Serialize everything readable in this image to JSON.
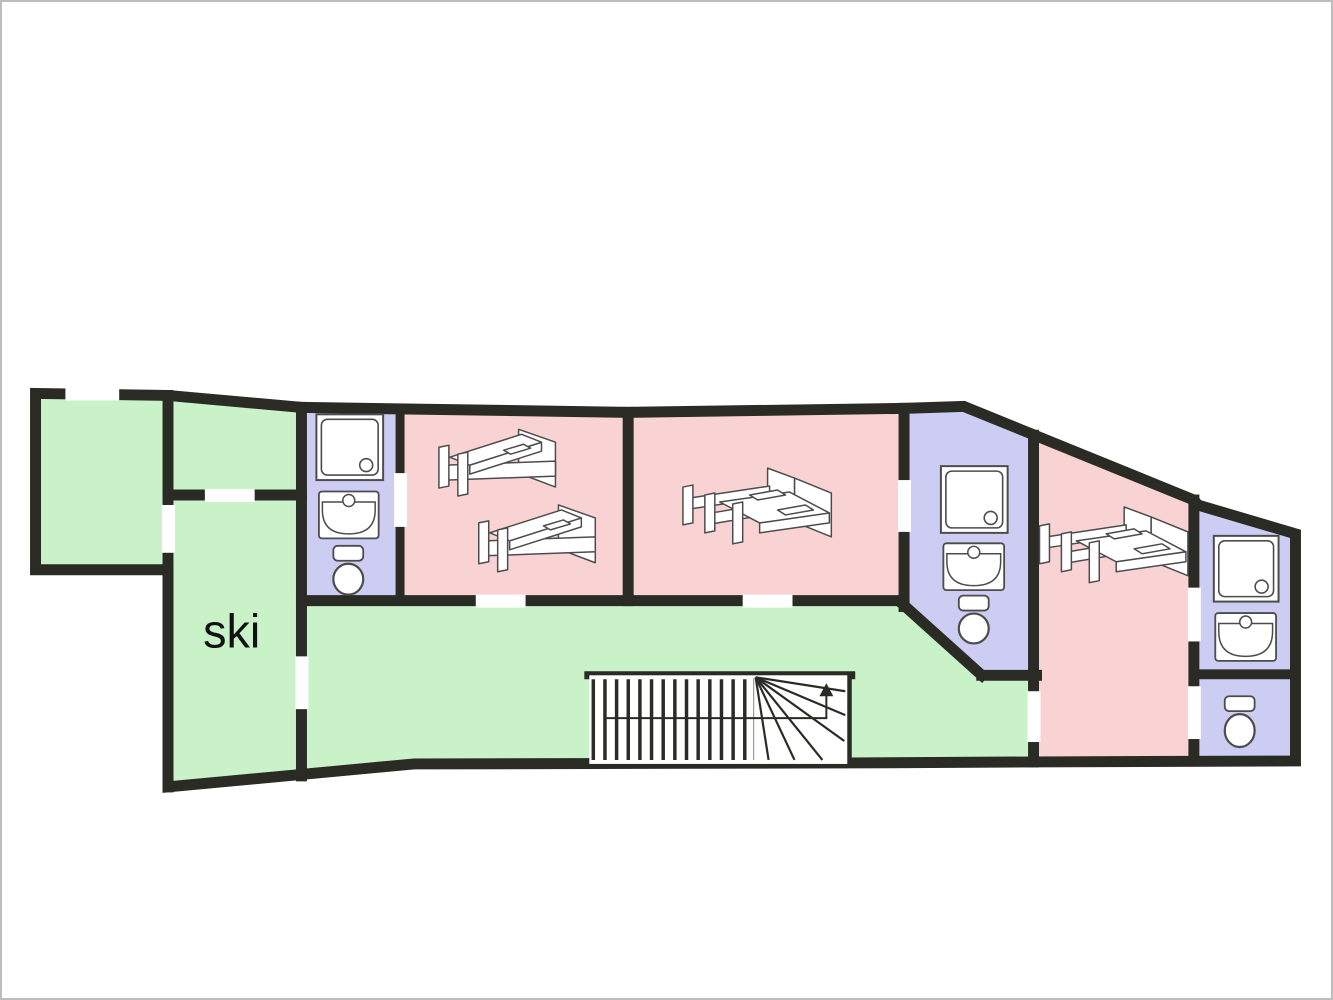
{
  "canvas": {
    "width": 1333,
    "height": 1000
  },
  "palette": {
    "wall": "#2b2b26",
    "green": "#c9f2c9",
    "pink": "#f9d3d3",
    "lavender": "#cdccf3",
    "fixture_fill": "#ffffff",
    "fixture_stroke": "#4c4c4c",
    "winder_line": "#9a9a9a",
    "label": "#111111",
    "opening": "#ffffff",
    "frame": "#bdbdbd",
    "background": "#ffffff"
  },
  "rooms": [
    {
      "id": "green-room-1",
      "color": "green",
      "points": [
        [
          33,
          393
        ],
        [
          166,
          395
        ],
        [
          166,
          570
        ],
        [
          33,
          570
        ]
      ]
    },
    {
      "id": "green-room-2",
      "color": "green",
      "points": [
        [
          166,
          395
        ],
        [
          300,
          407
        ],
        [
          300,
          495
        ],
        [
          166,
          495
        ]
      ]
    },
    {
      "id": "ski-room",
      "color": "green",
      "label": "ski",
      "label_pos": [
        230,
        648
      ],
      "label_size": 47,
      "points": [
        [
          166,
          495
        ],
        [
          300,
          495
        ],
        [
          300,
          777
        ],
        [
          166,
          788
        ]
      ]
    },
    {
      "id": "bathroom-1",
      "color": "lavender",
      "points": [
        [
          300,
          407
        ],
        [
          399,
          410
        ],
        [
          399,
          601
        ],
        [
          300,
          601
        ]
      ]
    },
    {
      "id": "bedroom-1",
      "color": "pink",
      "points": [
        [
          399,
          410
        ],
        [
          628,
          412
        ],
        [
          628,
          601
        ],
        [
          399,
          601
        ]
      ]
    },
    {
      "id": "bedroom-2",
      "color": "pink",
      "points": [
        [
          628,
          412
        ],
        [
          905,
          408
        ],
        [
          905,
          601
        ],
        [
          628,
          601
        ]
      ]
    },
    {
      "id": "bathroom-2",
      "color": "lavender",
      "points": [
        [
          905,
          408
        ],
        [
          965,
          406
        ],
        [
          1035,
          435
        ],
        [
          1035,
          676
        ],
        [
          983,
          676
        ],
        [
          905,
          606
        ]
      ]
    },
    {
      "id": "corridor",
      "color": "green",
      "points": [
        [
          300,
          601
        ],
        [
          905,
          601
        ],
        [
          905,
          606
        ],
        [
          983,
          676
        ],
        [
          1035,
          676
        ],
        [
          1035,
          763
        ],
        [
          413,
          765
        ],
        [
          300,
          777
        ]
      ]
    },
    {
      "id": "bedroom-3",
      "color": "pink",
      "points": [
        [
          1035,
          435
        ],
        [
          1196,
          500
        ],
        [
          1196,
          762
        ],
        [
          1035,
          763
        ]
      ]
    },
    {
      "id": "bathroom-3",
      "color": "lavender",
      "points": [
        [
          1196,
          500
        ],
        [
          1200,
          505
        ],
        [
          1298,
          534
        ],
        [
          1298,
          675
        ],
        [
          1196,
          675
        ]
      ]
    },
    {
      "id": "wc",
      "color": "lavender",
      "points": [
        [
          1196,
          675
        ],
        [
          1298,
          675
        ],
        [
          1298,
          762
        ],
        [
          1196,
          762
        ]
      ]
    }
  ],
  "outer_wall": {
    "width": 11,
    "points": [
      [
        33,
        393
      ],
      [
        166,
        395
      ],
      [
        300,
        407
      ],
      [
        628,
        412
      ],
      [
        905,
        408
      ],
      [
        965,
        406
      ],
      [
        1196,
        500
      ],
      [
        1200,
        505
      ],
      [
        1298,
        534
      ],
      [
        1298,
        762
      ],
      [
        1035,
        763
      ],
      [
        850,
        764
      ],
      [
        413,
        765
      ],
      [
        166,
        788
      ],
      [
        166,
        570
      ],
      [
        33,
        570
      ]
    ]
  },
  "interior_walls": [
    [
      166,
      395,
      166,
      788,
      11
    ],
    [
      166,
      495,
      300,
      495,
      11
    ],
    [
      300,
      407,
      300,
      777,
      11
    ],
    [
      399,
      410,
      399,
      601,
      9
    ],
    [
      300,
      601,
      905,
      601,
      11
    ],
    [
      628,
      412,
      628,
      601,
      11
    ],
    [
      905,
      408,
      905,
      607,
      11
    ],
    [
      903,
      604,
      983,
      676,
      11
    ],
    [
      983,
      676,
      1038,
      676,
      11
    ],
    [
      1035,
      435,
      1035,
      763,
      11
    ],
    [
      1196,
      500,
      1196,
      762,
      11
    ],
    [
      1196,
      675,
      1298,
      675,
      10
    ],
    [
      588,
      676,
      852,
      676,
      8
    ],
    [
      849,
      676,
      849,
      762,
      7
    ]
  ],
  "openings": [
    {
      "id": "window-green-room-1",
      "x": 63,
      "y": 387,
      "w": 54,
      "h": 13
    },
    {
      "id": "door-green-room-1-ski",
      "x": 160,
      "y": 505,
      "w": 13,
      "h": 48
    },
    {
      "id": "door-green-room-2-ski",
      "x": 203,
      "y": 489,
      "w": 50,
      "h": 13
    },
    {
      "id": "door-ski-corridor",
      "x": 294,
      "y": 657,
      "w": 13,
      "h": 53
    },
    {
      "id": "door-bathroom-1-bedroom-1",
      "x": 393,
      "y": 473,
      "w": 13,
      "h": 54
    },
    {
      "id": "door-bedroom-1-corridor",
      "x": 475,
      "y": 595,
      "w": 50,
      "h": 13
    },
    {
      "id": "door-bedroom-2-corridor",
      "x": 743,
      "y": 595,
      "w": 50,
      "h": 13
    },
    {
      "id": "door-bedroom-2-bathroom-2",
      "x": 899,
      "y": 480,
      "w": 13,
      "h": 52
    },
    {
      "id": "door-corridor-bedroom-3",
      "x": 1029,
      "y": 692,
      "w": 13,
      "h": 51
    },
    {
      "id": "door-bedroom-3-bathroom-3",
      "x": 1190,
      "y": 588,
      "w": 13,
      "h": 54
    },
    {
      "id": "door-bedroom-3-wc",
      "x": 1190,
      "y": 687,
      "w": 13,
      "h": 53
    }
  ],
  "fixtures": [
    {
      "type": "shower",
      "room": "bathroom-1",
      "x": 315,
      "y": 414,
      "w": 67,
      "h": 66
    },
    {
      "type": "sink",
      "room": "bathroom-1",
      "x": 317,
      "y": 491,
      "w": 61,
      "h": 48
    },
    {
      "type": "toilet",
      "room": "bathroom-1",
      "x": 331,
      "y": 546,
      "w": 32,
      "h": 50
    },
    {
      "type": "bed-single",
      "room": "bedroom-1",
      "x": 437,
      "y": 421
    },
    {
      "type": "bed-single",
      "room": "bedroom-1",
      "x": 477,
      "y": 497
    },
    {
      "type": "bed-double",
      "room": "bedroom-2",
      "x": 682,
      "y": 466
    },
    {
      "type": "shower",
      "room": "bathroom-2",
      "x": 942,
      "y": 466,
      "w": 67,
      "h": 67
    },
    {
      "type": "sink",
      "room": "bathroom-2",
      "x": 944,
      "y": 543,
      "w": 62,
      "h": 48
    },
    {
      "type": "toilet",
      "room": "bathroom-2",
      "x": 959,
      "y": 596,
      "w": 32,
      "h": 49
    },
    {
      "type": "bed-double",
      "room": "bedroom-3",
      "x": 1040,
      "y": 505
    },
    {
      "type": "shower",
      "room": "bathroom-3",
      "x": 1216,
      "y": 536,
      "w": 65,
      "h": 66
    },
    {
      "type": "sink",
      "room": "bathroom-3",
      "x": 1217,
      "y": 613,
      "w": 62,
      "h": 49
    },
    {
      "type": "toilet",
      "room": "wc",
      "x": 1226,
      "y": 697,
      "w": 32,
      "h": 52
    }
  ],
  "stairs": {
    "tread_x0": 593,
    "tread_dx": 11.7,
    "tread_count": 14,
    "tread_y1": 680,
    "tread_y2": 761,
    "winder_x": 754,
    "winder_y1": 679,
    "winder_y2": 761,
    "fan_center": [
      756,
      678
    ],
    "fan_ends": [
      [
        846,
        692
      ],
      [
        846,
        716
      ],
      [
        845,
        742
      ],
      [
        823,
        761
      ],
      [
        795,
        761
      ],
      [
        769,
        761
      ]
    ],
    "arrow": {
      "points": [
        [
          605,
          719
        ],
        [
          827,
          719
        ],
        [
          827,
          696
        ]
      ],
      "head": [
        [
          827,
          684
        ],
        [
          820,
          697
        ],
        [
          834,
          697
        ]
      ]
    }
  }
}
